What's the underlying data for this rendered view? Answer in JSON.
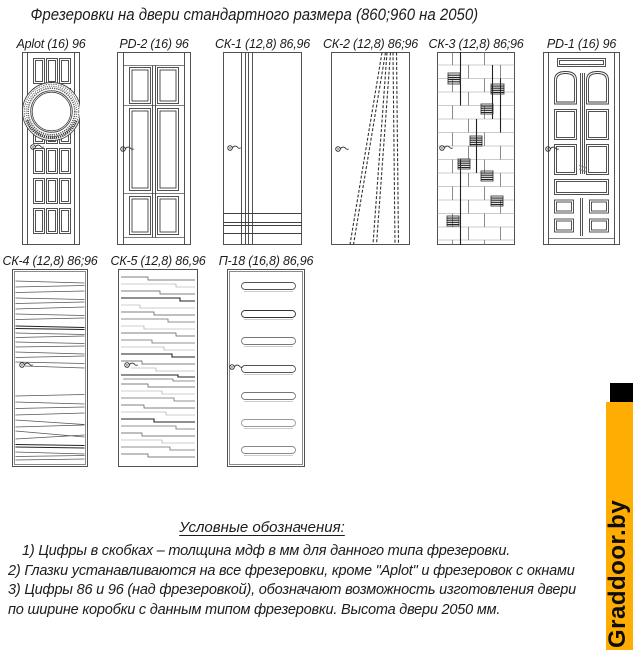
{
  "title": "Фрезеровки на двери стандартного размера (860;960 на 2050)",
  "doors": [
    {
      "id": "aplot",
      "label": "Aplot (16) 96"
    },
    {
      "id": "pd2",
      "label": "PD-2 (16) 96"
    },
    {
      "id": "ck1",
      "label": "СК-1 (12,8) 86,96"
    },
    {
      "id": "ck2",
      "label": "СК-2 (12,8) 86;96"
    },
    {
      "id": "ck3",
      "label": "СК-3 (12,8) 86;96"
    },
    {
      "id": "pd1",
      "label": "PD-1 (16) 96"
    },
    {
      "id": "ck4",
      "label": "СК-4 (12,8) 86;96"
    },
    {
      "id": "ck5",
      "label": "СК-5 (12,8) 86,96"
    },
    {
      "id": "p18",
      "label": "П-18 (16,8) 86,96"
    }
  ],
  "legend": {
    "heading": "Условные обозначения:",
    "lines": [
      "1) Цифры в скобках – толщина мдф в мм для данного типа фрезеровки.",
      "2) Глазки устанавливаются на все фрезеровки, кроме \"Aplot\" и фрезеровок с окнами",
      "3) Цифры 86 и 96 (над фрезеровкой), обозначают возможность изготовления двери",
      "по ширине коробки с данным типом фрезеровки. Высота двери 2050 мм."
    ]
  },
  "watermark": {
    "text": "Graddoor.by",
    "bar_color": "#FFAD02",
    "cap_color": "#000000",
    "text_color": "#0D0D0D"
  },
  "line_color": "#3F3F3F",
  "background_color": "#FFFFFF"
}
